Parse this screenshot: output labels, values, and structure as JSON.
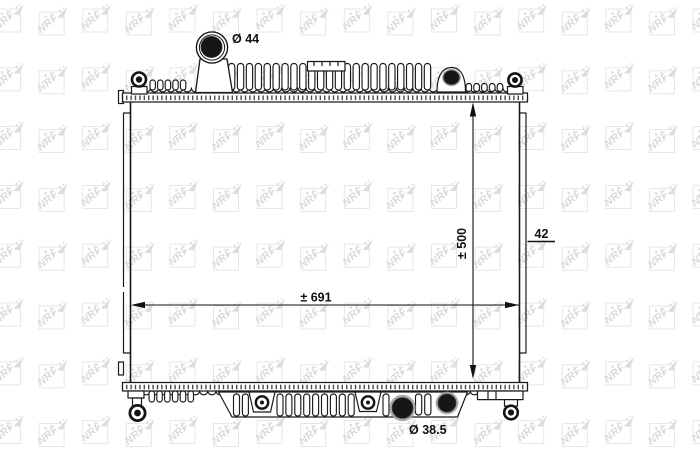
{
  "watermark": {
    "text": "NRF"
  },
  "diagram": {
    "subject": "radiator",
    "components": [
      "top-inlet-port",
      "top-tank",
      "core",
      "side-plates",
      "bottom-tank",
      "bottom-outlet-port",
      "mounting-pins"
    ],
    "labels": {
      "inlet_diameter": "Ø 44",
      "outlet_diameter": "Ø 38.5",
      "width_dimension": "± 691",
      "height_dimension": "± 500",
      "depth_dimension": "42"
    },
    "colors": {
      "ink": "#1a1a1a",
      "watermark_gray": "#c2c2c2",
      "port_fill": "#161616",
      "port_halo": "#9d9d9d"
    }
  }
}
